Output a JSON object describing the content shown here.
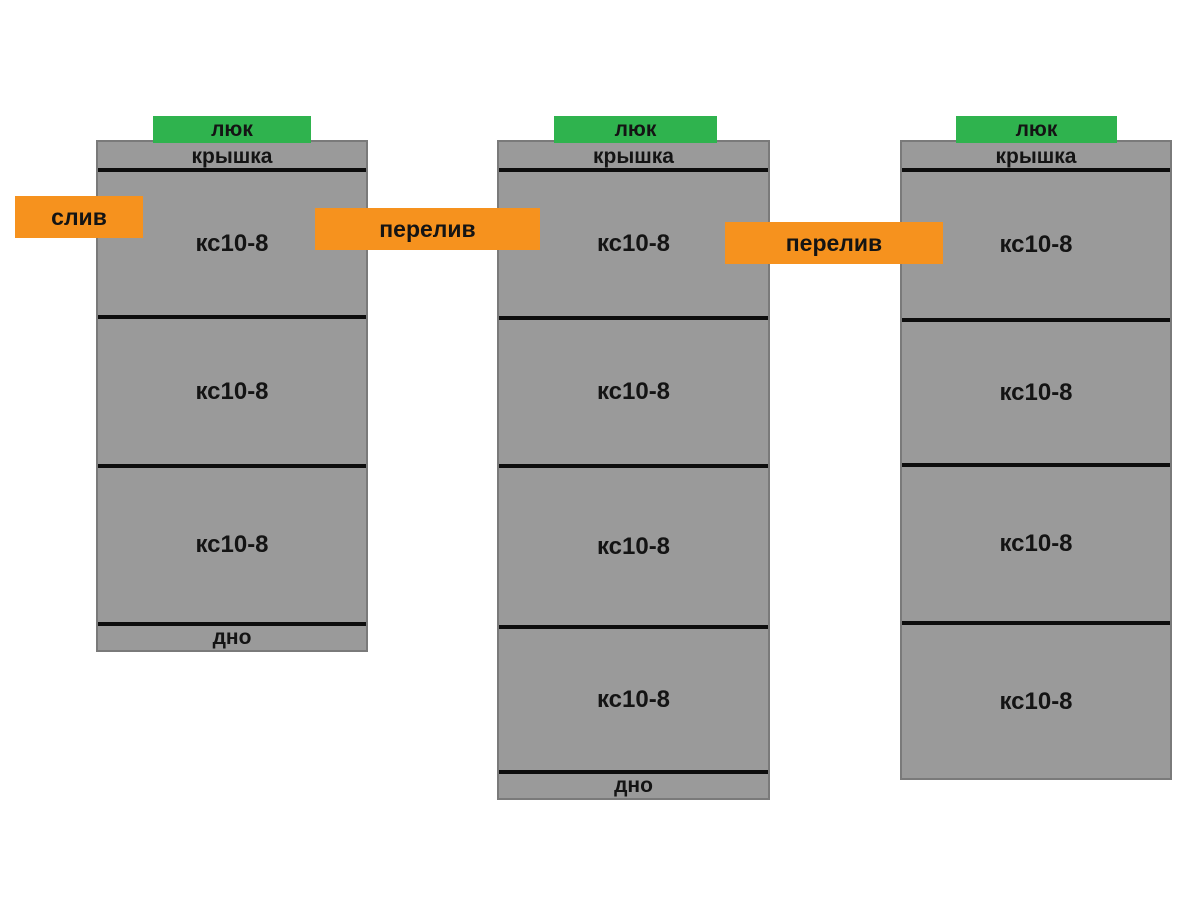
{
  "diagram": {
    "wells": [
      {
        "hatch_label": "люк",
        "lid_label": "крышка",
        "sections": [
          "кс10-8",
          "кс10-8",
          "кс10-8"
        ],
        "bottom_label": "дно"
      },
      {
        "hatch_label": "люк",
        "lid_label": "крышка",
        "sections": [
          "кс10-8",
          "кс10-8",
          "кс10-8",
          "кс10-8"
        ],
        "bottom_label": "дно"
      },
      {
        "hatch_label": "люк",
        "lid_label": "крышка",
        "sections": [
          "кс10-8",
          "кс10-8",
          "кс10-8",
          "кс10-8"
        ],
        "bottom_label": ""
      }
    ],
    "connectors": {
      "drain": "слив",
      "overflow_1": "перелив",
      "overflow_2": "перелив"
    },
    "colors": {
      "background": "#ffffff",
      "well_fill": "#9a9a9a",
      "well_border": "#7a7a7a",
      "divider_line": "#0d0d0d",
      "hatch_green": "#2fb34e",
      "connector_orange": "#f6921e",
      "text": "#141414"
    }
  }
}
